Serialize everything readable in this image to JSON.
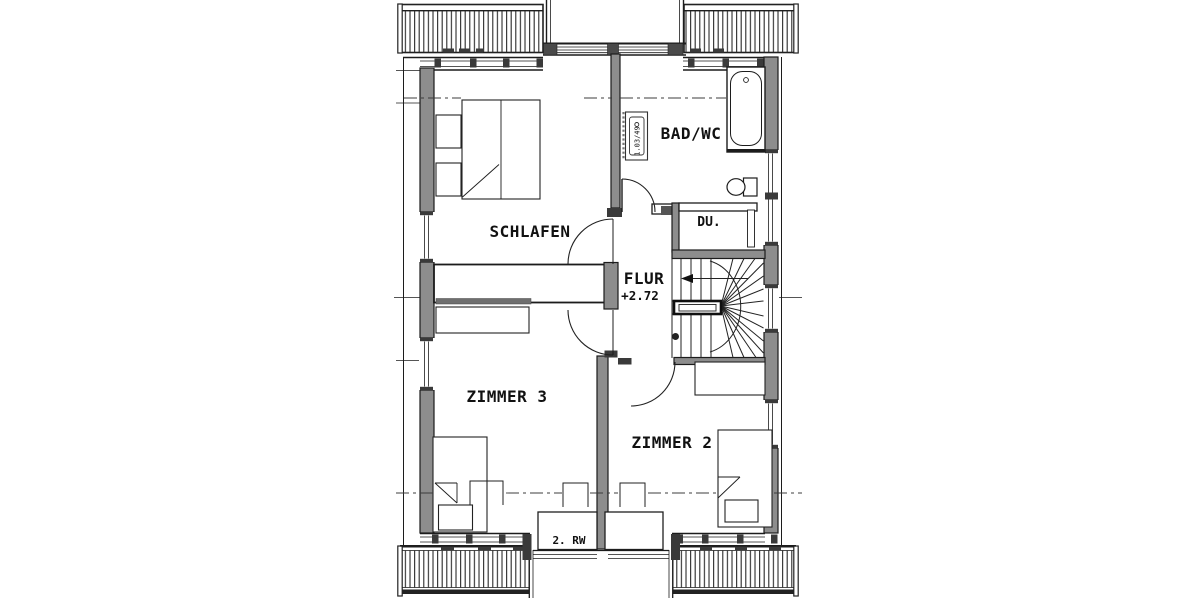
{
  "plan": {
    "rooms": [
      {
        "id": "schlafen",
        "label": "SCHLAFEN"
      },
      {
        "id": "bad",
        "label": "BAD/WC"
      },
      {
        "id": "dusche",
        "label": "DU."
      },
      {
        "id": "flur",
        "label": "FLUR",
        "level": "+2.72"
      },
      {
        "id": "zimmer3",
        "label": "ZIMMER 3"
      },
      {
        "id": "zimmer2",
        "label": "ZIMMER 2"
      }
    ],
    "annotations": {
      "escape_route": "2. RW",
      "fixture_tag": "1.03/49"
    },
    "colors": {
      "background": "#ffffff",
      "line": "#1c1c1c",
      "wall_fill": "#8d8d8d"
    }
  }
}
